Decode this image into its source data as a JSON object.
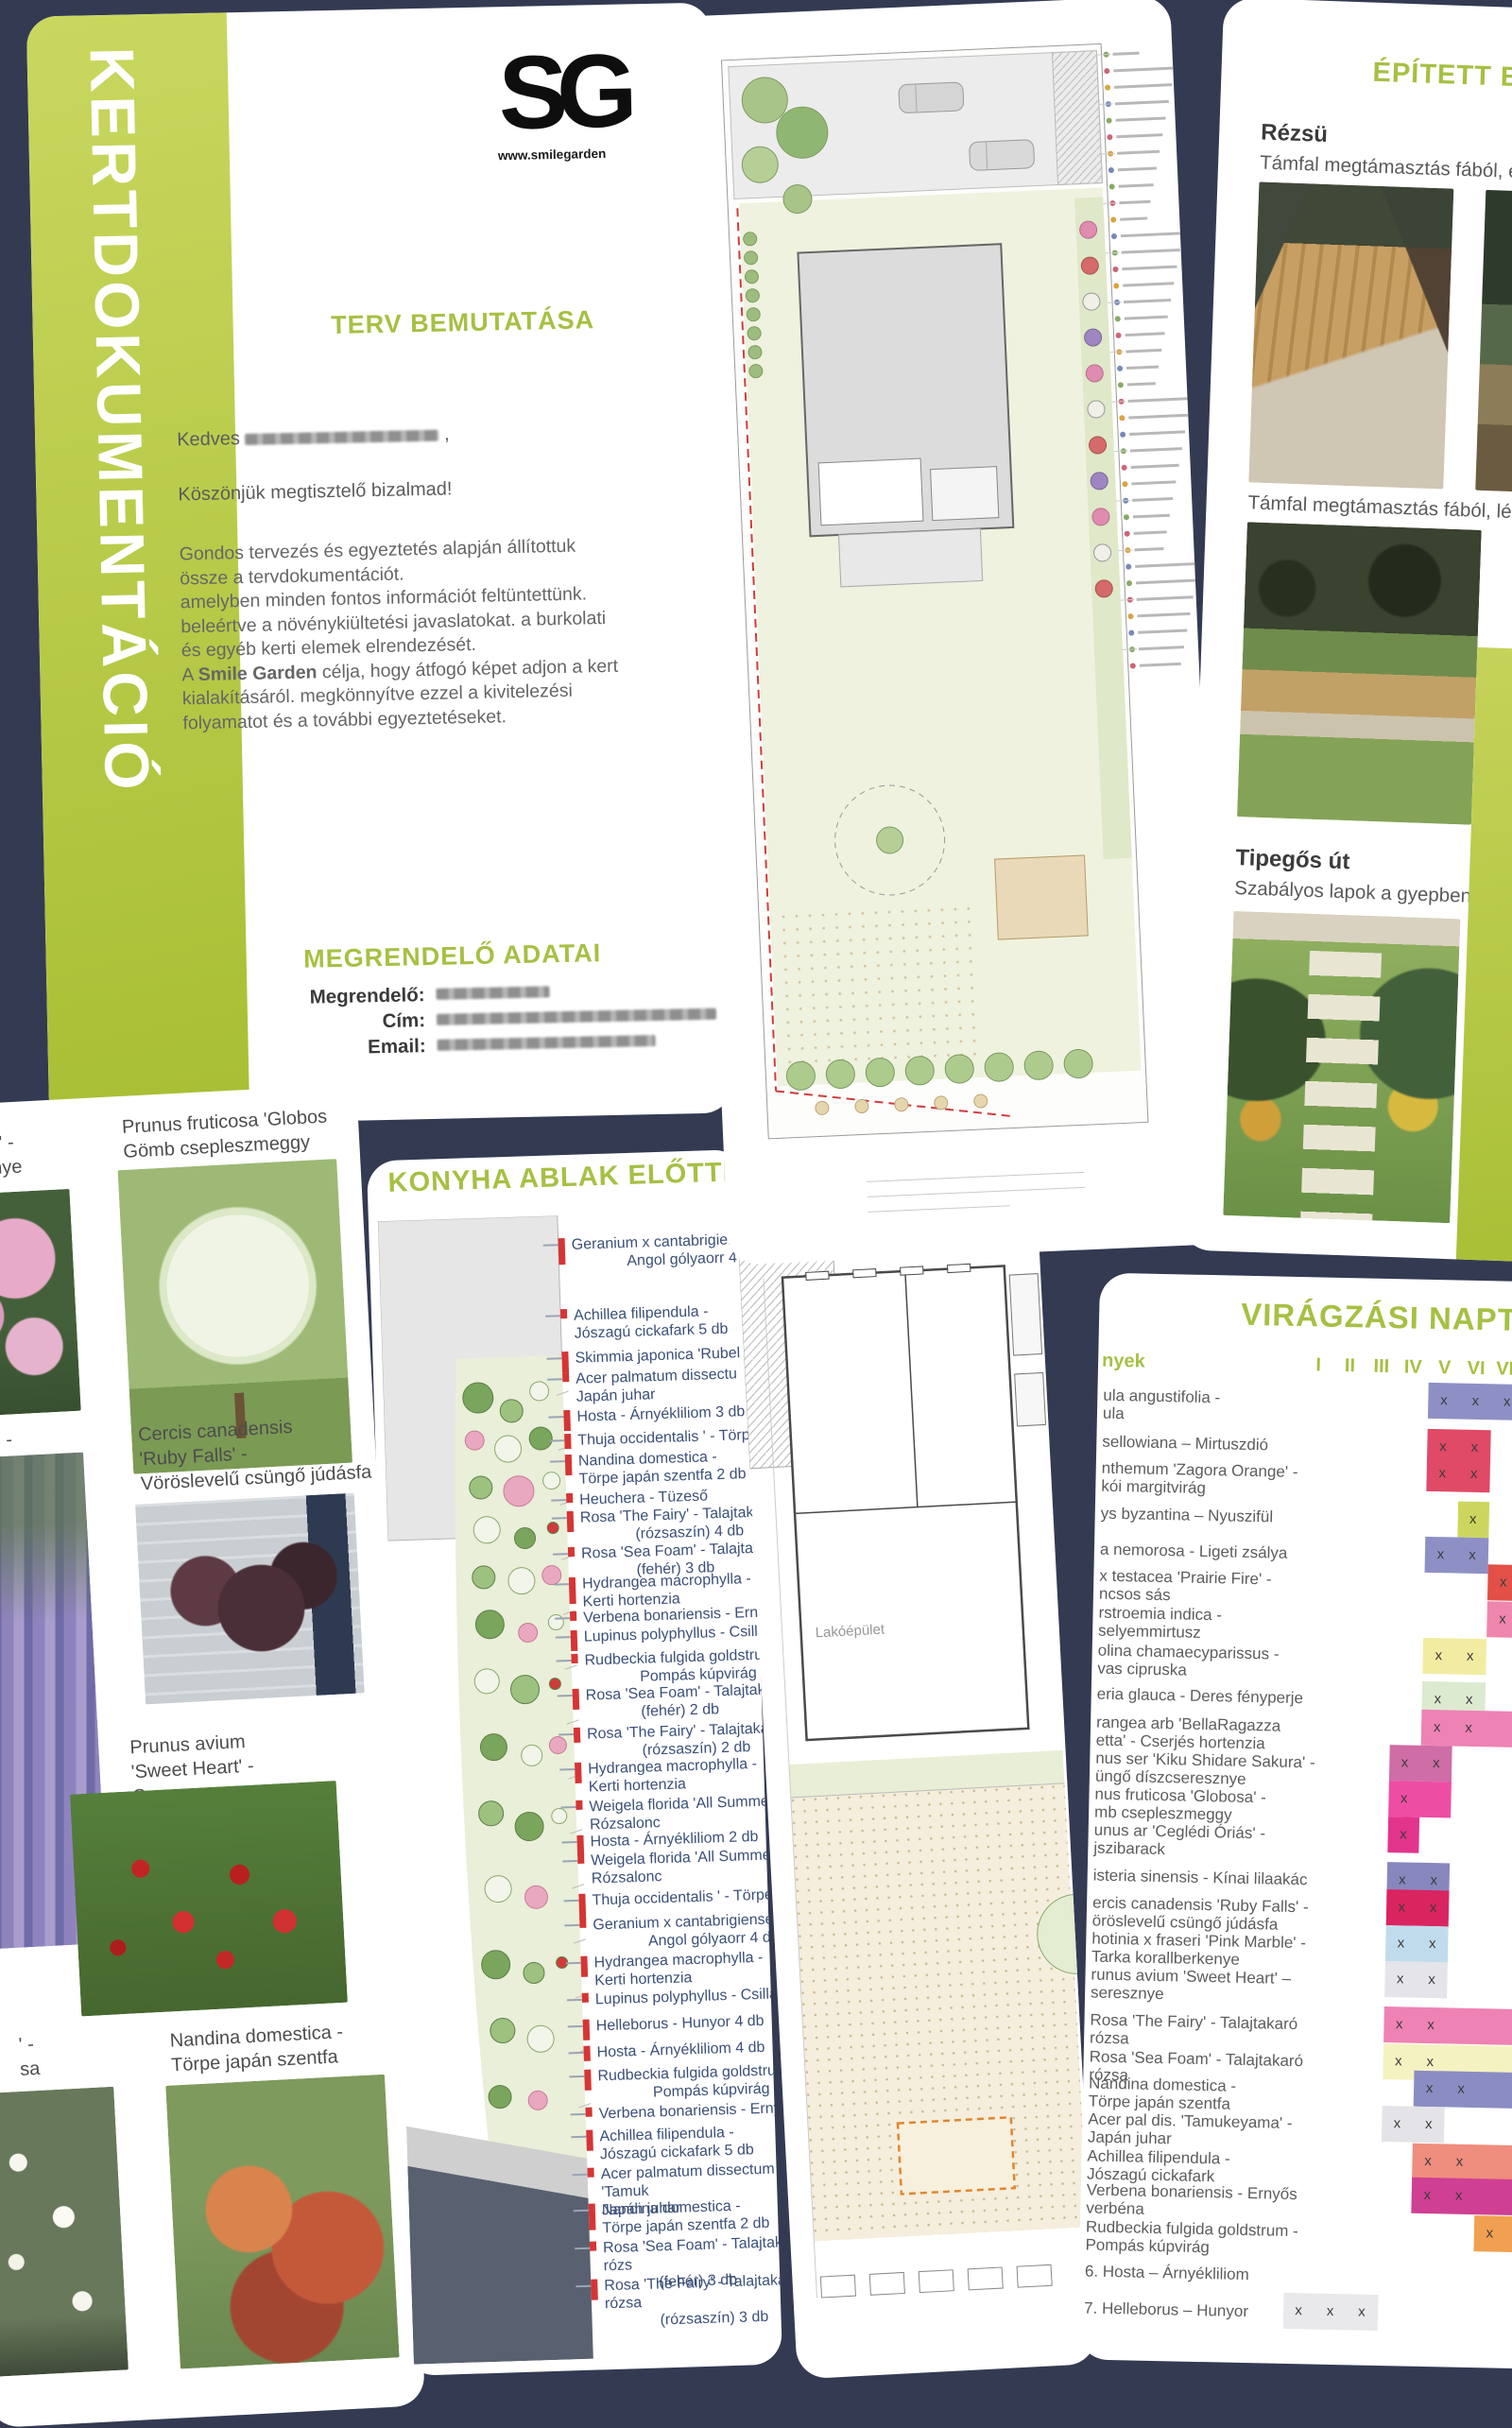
{
  "colors": {
    "background": "#343a52",
    "accent_green": "#a6c043",
    "banner_green": "#b9cc3f",
    "list_text": "#3c5078",
    "marker_red": "#d63535"
  },
  "page1": {
    "banner": "KERTDOKUMENTÁCIÓ",
    "logo": "SG",
    "logo_site": "www.smilegarden",
    "title": "TERV BEMUTATÁSA",
    "greeting": "Kedves",
    "greeting_comma": ",",
    "thanks": "Köszönjük megtisztelő bizalmad!",
    "paragraph": [
      "Gondos tervezés és egyeztetés alapján állítottuk",
      "össze a tervdokumentációt.",
      "amelyben minden fontos információt feltüntettünk.",
      "beleértve a növénykiültetési javaslatokat. a burkolati",
      "és egyéb kerti elemek elrendezését.",
      "A **Smile Garden** célja, hogy átfogó képet adjon a kert",
      "kialakításáról. megkönnyítve ezzel a kivitelezési",
      "folyamatot és a további egyeztetéseket."
    ],
    "customer_heading": "MEGRENDELŐ ADATAI",
    "fields": [
      "Megrendelő:",
      "Cím:",
      "Email:"
    ]
  },
  "page3": {
    "title": "ÉPÍTETT E",
    "sections": [
      {
        "heading": "Rézsü",
        "subtitle": "Támfal megtámasztás fából, elé"
      },
      {
        "heading": "",
        "subtitle": "Támfal megtámasztás fából, lépc"
      },
      {
        "heading": "Tipegős út",
        "subtitle": "Szabályos lapok a gyepben"
      }
    ]
  },
  "page4": {
    "entries": [
      {
        "lines": [
          "ura' -",
          "sznye"
        ],
        "photo": "pink-blossom"
      },
      {
        "lines": [
          "Prunus fruticosa 'Globos",
          "Gömb csepleszmeggy"
        ],
        "photo": "globe-tree"
      },
      {
        "lines": [
          "is -"
        ],
        "photo": "wisteria"
      },
      {
        "lines": [
          "Cercis canadensis",
          "'Ruby Falls' -",
          "Vöröslevelű csüngő júdásfa"
        ],
        "photo": "ruby-falls"
      },
      {
        "lines": [
          "Prunus avium",
          "'Sweet Heart' -",
          "Cseresznye"
        ],
        "photo": "cherries"
      },
      {
        "lines": [
          "' -",
          "sa"
        ],
        "photo": "white-flowers"
      },
      {
        "lines": [
          "Nandina domestica -",
          "Törpe japán szentfa"
        ],
        "photo": "nandina"
      }
    ]
  },
  "page5": {
    "title": "KONYHA ABLAK ELŐTTI N",
    "labels": [
      {
        "lines": [
          "Geranium x cantabrigiens",
          "Angol gólyaorr 4 db"
        ],
        "indent": true
      },
      {
        "lines": [
          "Achillea filipendula -",
          "Jószagú cickafark 5 db"
        ]
      },
      {
        "lines": [
          "Skimmia japonica 'Rubel"
        ]
      },
      {
        "lines": [
          "Acer palmatum dissectu",
          "Japán juhar"
        ]
      },
      {
        "lines": [
          "Hosta - Árnyékliliom 3 db"
        ]
      },
      {
        "lines": [
          "Thuja occidentalis ' - Törp"
        ]
      },
      {
        "lines": [
          "Nandina domestica -",
          "Törpe japán szentfa 2 db"
        ]
      },
      {
        "lines": [
          "Heuchera - Tüzeső"
        ]
      },
      {
        "lines": [
          "Rosa 'The Fairy' - Talajtaka",
          "(rózsaszín) 4 db"
        ],
        "indent": true
      },
      {
        "lines": [
          "Rosa 'Sea Foam' - Talajtak",
          "(fehér) 3 db"
        ],
        "indent": true
      },
      {
        "lines": [
          "Hydrangea macrophylla -",
          "Kerti hortenzia"
        ]
      },
      {
        "lines": [
          "Verbena bonariensis - Erny"
        ]
      },
      {
        "lines": [
          "Lupinus polyphyllus - Csillag"
        ]
      },
      {
        "lines": [
          "Rudbeckia fulgida goldstrum",
          "Pompás kúpvirág 5 db"
        ],
        "indent": true
      },
      {
        "lines": [
          "Rosa 'Sea Foam' - Talajtakaró",
          "(fehér) 2 db"
        ],
        "indent": true
      },
      {
        "lines": [
          "Rosa 'The Fairy' - Talajtakaró r",
          "(rózsaszín) 2 db"
        ],
        "indent": true
      },
      {
        "lines": [
          "Hydrangea macrophylla -",
          "Kerti hortenzia"
        ]
      },
      {
        "lines": [
          "Weigela florida 'All Summer Re",
          "Rózsalonc"
        ]
      },
      {
        "lines": [
          "Hosta - Árnyékliliom 2 db"
        ]
      },
      {
        "lines": [
          "Weigela florida 'All Summer Re",
          "Rózsalonc"
        ]
      },
      {
        "lines": [
          "Thuja occidentalis ' - Törpe osz"
        ]
      },
      {
        "lines": [
          "Geranium x cantabrigiense -",
          "Angol gólyaorr 4 db"
        ],
        "indent": true
      },
      {
        "lines": [
          "Hydrangea macrophylla -",
          "Kerti hortenzia"
        ]
      },
      {
        "lines": [
          "Lupinus polyphyllus - Csillagfürt"
        ]
      },
      {
        "lines": [
          "Helleborus - Hunyor 4 db"
        ]
      },
      {
        "lines": [
          "Hosta - Árnyékliliom 4 db"
        ]
      },
      {
        "lines": [
          "Rudbeckia fulgida goldstrum -",
          "Pompás kúpvirág"
        ],
        "indent": true
      },
      {
        "lines": [
          "Verbena bonariensis - Ernyős v"
        ]
      },
      {
        "lines": [
          "Achillea filipendula -",
          "Jószagú cickafark 5 db"
        ]
      },
      {
        "lines": [
          "Acer palmatum dissectum 'Tamuk",
          "Japán juhar"
        ]
      },
      {
        "lines": [
          "Nandina domestica -",
          "Törpe japán szentfa 2 db"
        ]
      },
      {
        "lines": [
          "Rosa 'Sea Foam' - Talajtakaró rózs",
          "(fehér) 3 db"
        ],
        "indent": true
      },
      {
        "lines": [
          "Rosa 'The Fairy' - Talajtakaró rózsa",
          "(rózsaszín) 3 db"
        ],
        "indent": true
      }
    ]
  },
  "page6": {
    "building_label": "Lakóépület"
  },
  "page7": {
    "title": "VIRÁGZÁSI NAPTÁR",
    "plants_header": "nyek",
    "months": [
      "I",
      "II",
      "III",
      "IV",
      "V",
      "VI",
      "VII"
    ],
    "rows": [
      {
        "lines": [
          "ula angustifolia -",
          "ula"
        ],
        "color": "#8e90c5",
        "span": [
          5,
          8
        ],
        "x": [
          5,
          6,
          7
        ]
      },
      {
        "lines": [
          "sellowiana – Mirtuszdió"
        ],
        "color": "#e04a66",
        "span": [
          5,
          6
        ],
        "x": [
          5,
          6
        ]
      },
      {
        "lines": [
          "nthemum 'Zagora Orange' -",
          "kói margitvirág"
        ],
        "color": "#e04a66",
        "span": [
          5,
          6
        ],
        "x": [
          5,
          6
        ]
      },
      {
        "lines": [
          "ys byzantina – Nyuszifül"
        ],
        "color": "#ccd65e",
        "span": [
          6,
          6
        ],
        "x": [
          6
        ]
      },
      {
        "lines": [
          "a nemorosa - Ligeti zsálya"
        ],
        "color": "#8e90c5",
        "span": [
          5,
          6
        ],
        "x": [
          5,
          6
        ]
      },
      {
        "lines": [
          "x testacea 'Prairie Fire' -",
          "ncsos sás"
        ],
        "color": "#e25048",
        "span": [
          7,
          8
        ],
        "x": [
          7
        ]
      },
      {
        "lines": [
          "rstroemia indica -",
          "selyemmirtusz"
        ],
        "color": "#ef86ae",
        "span": [
          7,
          8
        ],
        "x": [
          7
        ]
      },
      {
        "lines": [
          "olina chamaecyparissus -",
          "vas cipruska"
        ],
        "color": "#f2eca2",
        "span": [
          5,
          6
        ],
        "x": [
          5,
          6
        ]
      },
      {
        "lines": [
          "eria glauca - Deres fényperje"
        ],
        "color": "#dcead0",
        "span": [
          5,
          6
        ],
        "x": [
          5,
          6
        ]
      },
      {
        "lines": [
          "rangea arb 'BellaRagazza",
          "etta' - Cserjés hortenzia"
        ],
        "color": "#ee82b4",
        "span": [
          5,
          7
        ],
        "x": [
          5,
          6
        ]
      },
      {
        "lines": [
          "nus ser 'Kiku Shidare Sakura' -",
          "üngő díszcseresznye"
        ],
        "color": "#cf6da6",
        "span": [
          4,
          5
        ],
        "x": [
          4,
          5
        ]
      },
      {
        "lines": [
          "nus fruticosa 'Globosa' -",
          "mb csepleszmeggy"
        ],
        "color": "#ee4da4",
        "span": [
          4,
          5
        ],
        "x": [
          4
        ]
      },
      {
        "lines": [
          "unus ar 'Ceglédi Óriás' -",
          "jszibarack"
        ],
        "color": "#e3348c",
        "span": [
          4,
          4
        ],
        "x": [
          4
        ]
      },
      {
        "lines": [
          "isteria sinensis - Kínai lilaakác"
        ],
        "color": "#8887bd",
        "span": [
          4,
          5
        ],
        "x": [
          4,
          5
        ]
      },
      {
        "lines": [
          "ercis canadensis 'Ruby Falls' -",
          "öröslevelű csüngő júdásfa"
        ],
        "color": "#da2460",
        "span": [
          4,
          5
        ],
        "x": [
          4,
          5
        ]
      },
      {
        "lines": [
          "hotinia x fraseri 'Pink Marble' -",
          "Tarka korallberkenye"
        ],
        "color": "#c0dcec",
        "span": [
          4,
          5
        ],
        "x": [
          4,
          5
        ]
      },
      {
        "lines": [
          "runus avium 'Sweet Heart' –",
          "seresznye"
        ],
        "color": "#e4e4ea",
        "span": [
          4,
          5
        ],
        "x": [
          4,
          5
        ]
      },
      {
        "lines": [
          "Rosa 'The Fairy' - Talajtakaró rózsa"
        ],
        "color": "#ee82b4",
        "span": [
          4,
          8
        ],
        "x": [
          4,
          5
        ]
      },
      {
        "lines": [
          "Rosa 'Sea Foam' - Talajtakaró rózsa"
        ],
        "color": "#f5f2c2",
        "span": [
          4,
          8
        ],
        "x": [
          4,
          5
        ]
      },
      {
        "lines": [
          "Nandina domestica -",
          "Törpe japán szentfa"
        ],
        "color": "#8b8cc3",
        "span": [
          5,
          8
        ],
        "x": [
          5,
          6
        ]
      },
      {
        "lines": [
          "Acer pal dis. 'Tamukeyama' -",
          "Japán juhar"
        ],
        "color": "#e4e4e8",
        "span": [
          4,
          5
        ],
        "x": [
          4,
          5
        ]
      },
      {
        "lines": [
          "Achillea filipendula -",
          "Jószagú cickafark"
        ],
        "color": "#ef8d7e",
        "span": [
          5,
          8
        ],
        "x": [
          5,
          6
        ]
      },
      {
        "lines": [
          "Verbena bonariensis - Ernyős",
          "verbéna"
        ],
        "color": "#cf3f93",
        "span": [
          5,
          8
        ],
        "x": [
          5,
          6
        ]
      },
      {
        "lines": [
          "Rudbeckia fulgida goldstrum -",
          "Pompás kúpvirág"
        ],
        "color": "#f0a050",
        "span": [
          7,
          8
        ],
        "x": [
          7
        ]
      },
      {
        "lines": [
          "6. Hosta – Árnyékliliom"
        ],
        "color": null,
        "span": null,
        "x": []
      },
      {
        "lines": [
          "7. Helleborus – Hunyor"
        ],
        "color": "#e9e9ec",
        "span": [
          1,
          3
        ],
        "x": [
          1,
          2,
          3
        ]
      }
    ]
  }
}
